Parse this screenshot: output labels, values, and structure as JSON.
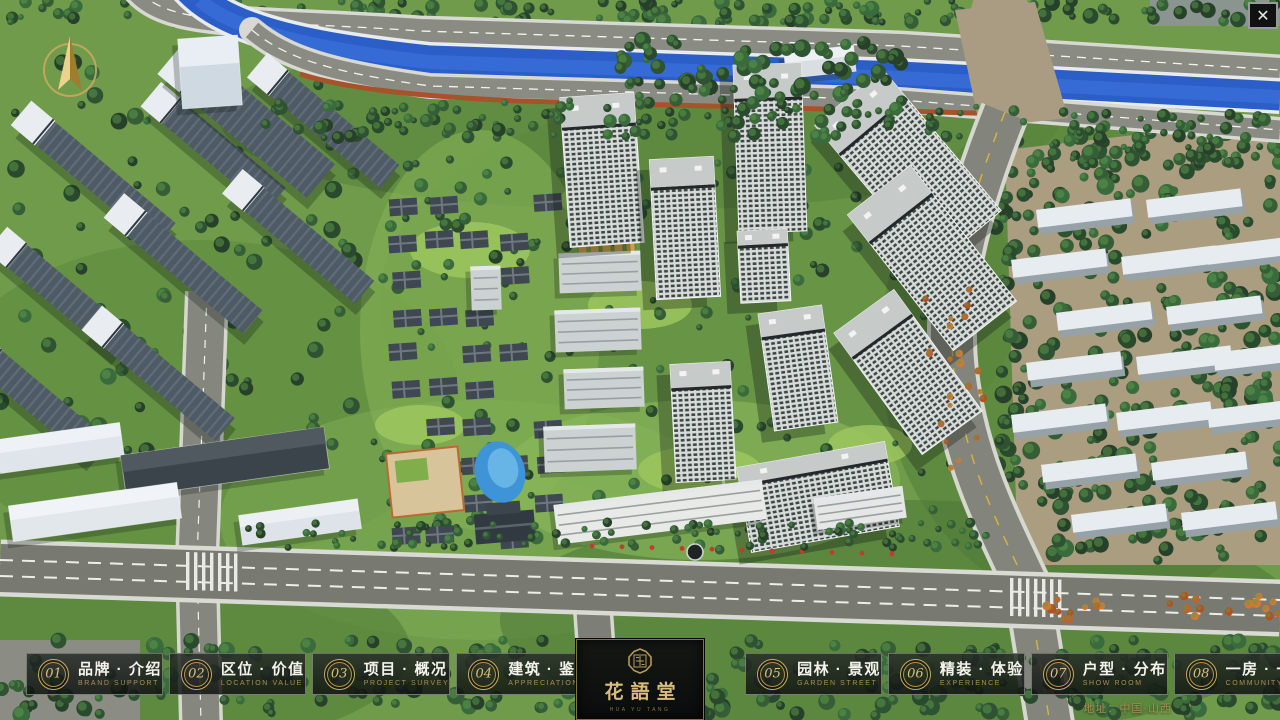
{
  "window": {
    "close_icon": "✕"
  },
  "nav": {
    "items": [
      {
        "num": "01",
        "label": "品牌 · 介绍",
        "sub": "BRAND SUPPORT"
      },
      {
        "num": "02",
        "label": "区位 · 价值",
        "sub": "LOCATION VALUE"
      },
      {
        "num": "03",
        "label": "项目 · 概况",
        "sub": "PROJECT SURVEY"
      },
      {
        "num": "04",
        "label": "建筑 · 鉴赏",
        "sub": "APPRECIATION"
      },
      {
        "num": "05",
        "label": "园林 · 景观",
        "sub": "GARDEN STREET"
      },
      {
        "num": "06",
        "label": "精装 · 体验",
        "sub": "EXPERIENCE"
      },
      {
        "num": "07",
        "label": "户型 · 分布",
        "sub": "SHOW ROOM"
      },
      {
        "num": "08",
        "label": "一房 · 一景",
        "sub": "COMMUNITY"
      }
    ],
    "logo": {
      "title": "花語堂",
      "subtitle": "HUA YU TANG"
    }
  },
  "footer": {
    "address": "地址：中国·山西"
  },
  "colors": {
    "accent_gold": "#c9aa62",
    "river_blue": "#2b5ec6",
    "tree_green": "#2f5233",
    "navbar_bg": "rgba(20,24,22,0.84)"
  }
}
